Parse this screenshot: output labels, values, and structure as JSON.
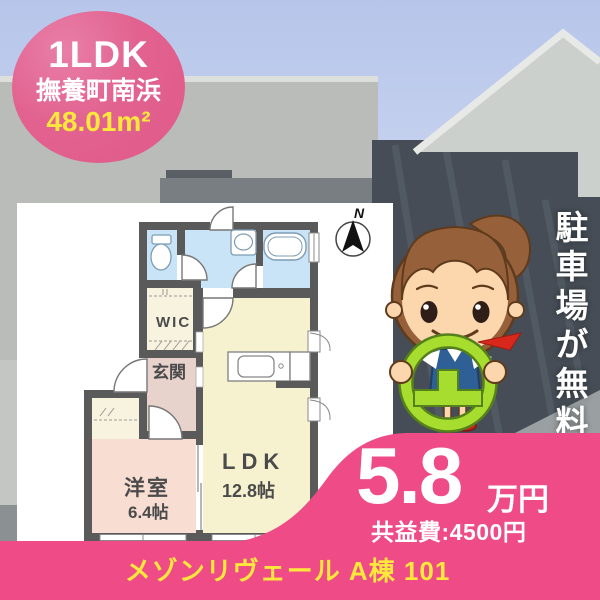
{
  "badge": {
    "layout": "1LDK",
    "location": "撫養町南浜",
    "area": "48.01m²"
  },
  "floor_plan": {
    "compass": "N",
    "labels": {
      "wic": "WIC",
      "genkan": "玄関",
      "western_name": "洋室",
      "western_size": "6.4帖",
      "ldk_name": "LDK",
      "ldk_size": "12.8帖"
    }
  },
  "banner": {
    "text": "駐車場が無料"
  },
  "price": {
    "rent": "5.8",
    "unit": "万円",
    "common_fee": "共益費:4500円"
  },
  "footer": {
    "property_name": "メゾンリヴェール A棟 101"
  },
  "colors": {
    "accent_pink": "#ee4b87",
    "badge_pink": "#e2628f",
    "highlight_yellow": "#ffe83c",
    "wall_gray": "#5a5a5a",
    "room_blue": "#c9e4f6",
    "room_yellow": "#f6f2d0",
    "room_pink": "#f8ddd2",
    "room_cream": "#f8f3de",
    "hall_rose": "#e7d3cb",
    "wheel_green": "#a6dd2e"
  }
}
